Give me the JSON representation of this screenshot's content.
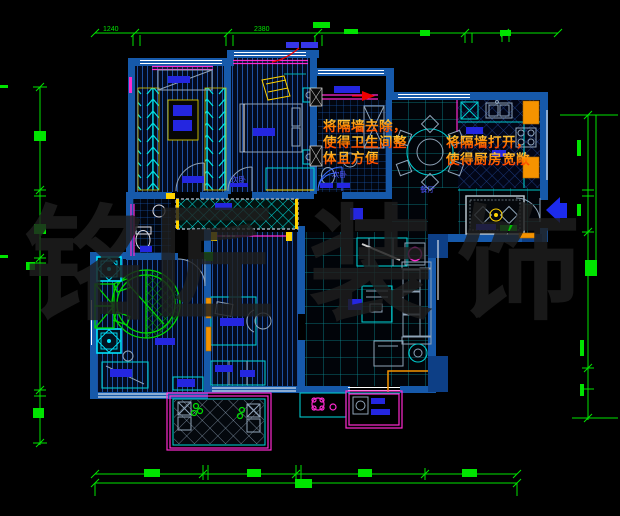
{
  "canvas": {
    "width": 620,
    "height": 516,
    "background": "#000000"
  },
  "palette": {
    "wall_blue": "#1659aa",
    "dimension_green": "#00e400",
    "furniture_cyan": "#00c8cc",
    "furniture_green": "#00da00",
    "accent_magenta": "#ff2ad0",
    "accent_yellow": "#ffd300",
    "accent_orange": "#f59300",
    "label_blue": "#2426e0",
    "annotation_red": "#ff3300",
    "watermark_gray": "#1e1e1e",
    "entry_arrow_blue": "#1c2bee"
  },
  "annotations": {
    "remove_wall_note": {
      "line1": "将隔墙去除，",
      "line2": "使得卫生间整",
      "line3": "体且方便"
    },
    "open_kitchen_note": {
      "line1": "将隔墙打开，",
      "line2": "使得厨房宽敞"
    }
  },
  "room_labels": {
    "bedroom2_a": "次卧",
    "bedroom2_b": "次卧",
    "dining": "餐厅"
  },
  "dimensions": {
    "top_left_value": "1240",
    "top_mid_value": "2380"
  },
  "watermark": {
    "char1": "铭",
    "char2": "匠",
    "char3": "装",
    "char4": "饰"
  }
}
